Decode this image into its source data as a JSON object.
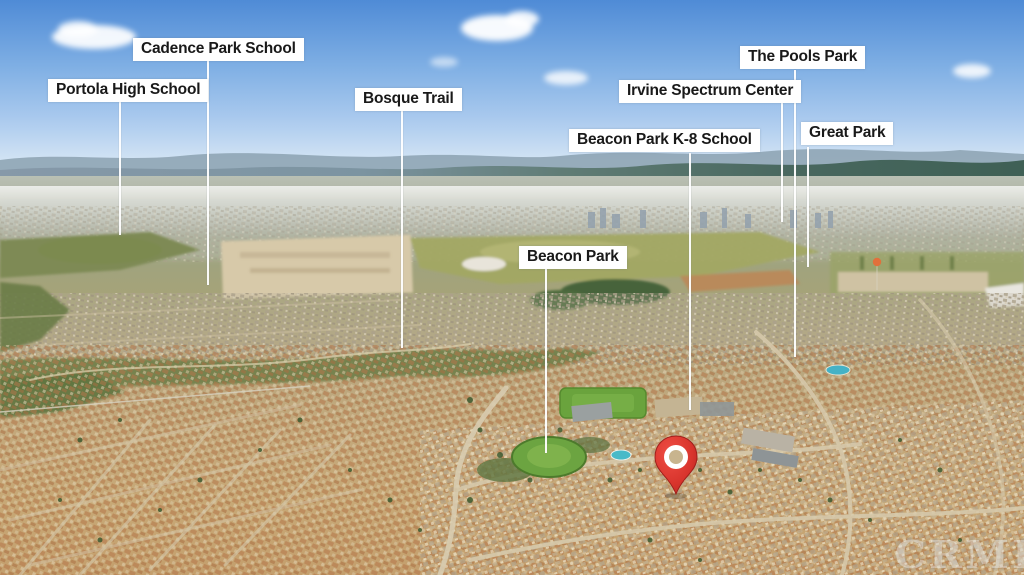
{
  "image_type": "aerial-neighborhood-photo-with-location-callouts",
  "annotations": [
    {
      "id": "portola-high-school",
      "label": "Portola High School"
    },
    {
      "id": "cadence-park-school",
      "label": "Cadence Park School"
    },
    {
      "id": "bosque-trail",
      "label": "Bosque Trail"
    },
    {
      "id": "beacon-park",
      "label": "Beacon Park"
    },
    {
      "id": "beacon-park-k8-school",
      "label": "Beacon Park K-8 School"
    },
    {
      "id": "irvine-spectrum-center",
      "label": "Irvine Spectrum Center"
    },
    {
      "id": "the-pools-park",
      "label": "The Pools Park"
    },
    {
      "id": "great-park",
      "label": "Great Park"
    }
  ],
  "pin": {
    "name": "property-location-pin",
    "color": "#d8342c",
    "inner_color": "#c8b48e"
  },
  "watermark": {
    "text": "CRMLS"
  },
  "colors": {
    "sky_top": "#4f8bd6",
    "sky_horizon": "#e9f1f6",
    "mountains": "#5d7a72",
    "fields_green": "#9aa45e",
    "dirt_tan": "#d7c9a9",
    "suburb_warm": "#c2996a",
    "park_green": "#6ca441",
    "pool_blue": "#49bac8",
    "label_bg": "#ffffff",
    "label_text": "#191919",
    "leader_line": "#ffffff"
  }
}
